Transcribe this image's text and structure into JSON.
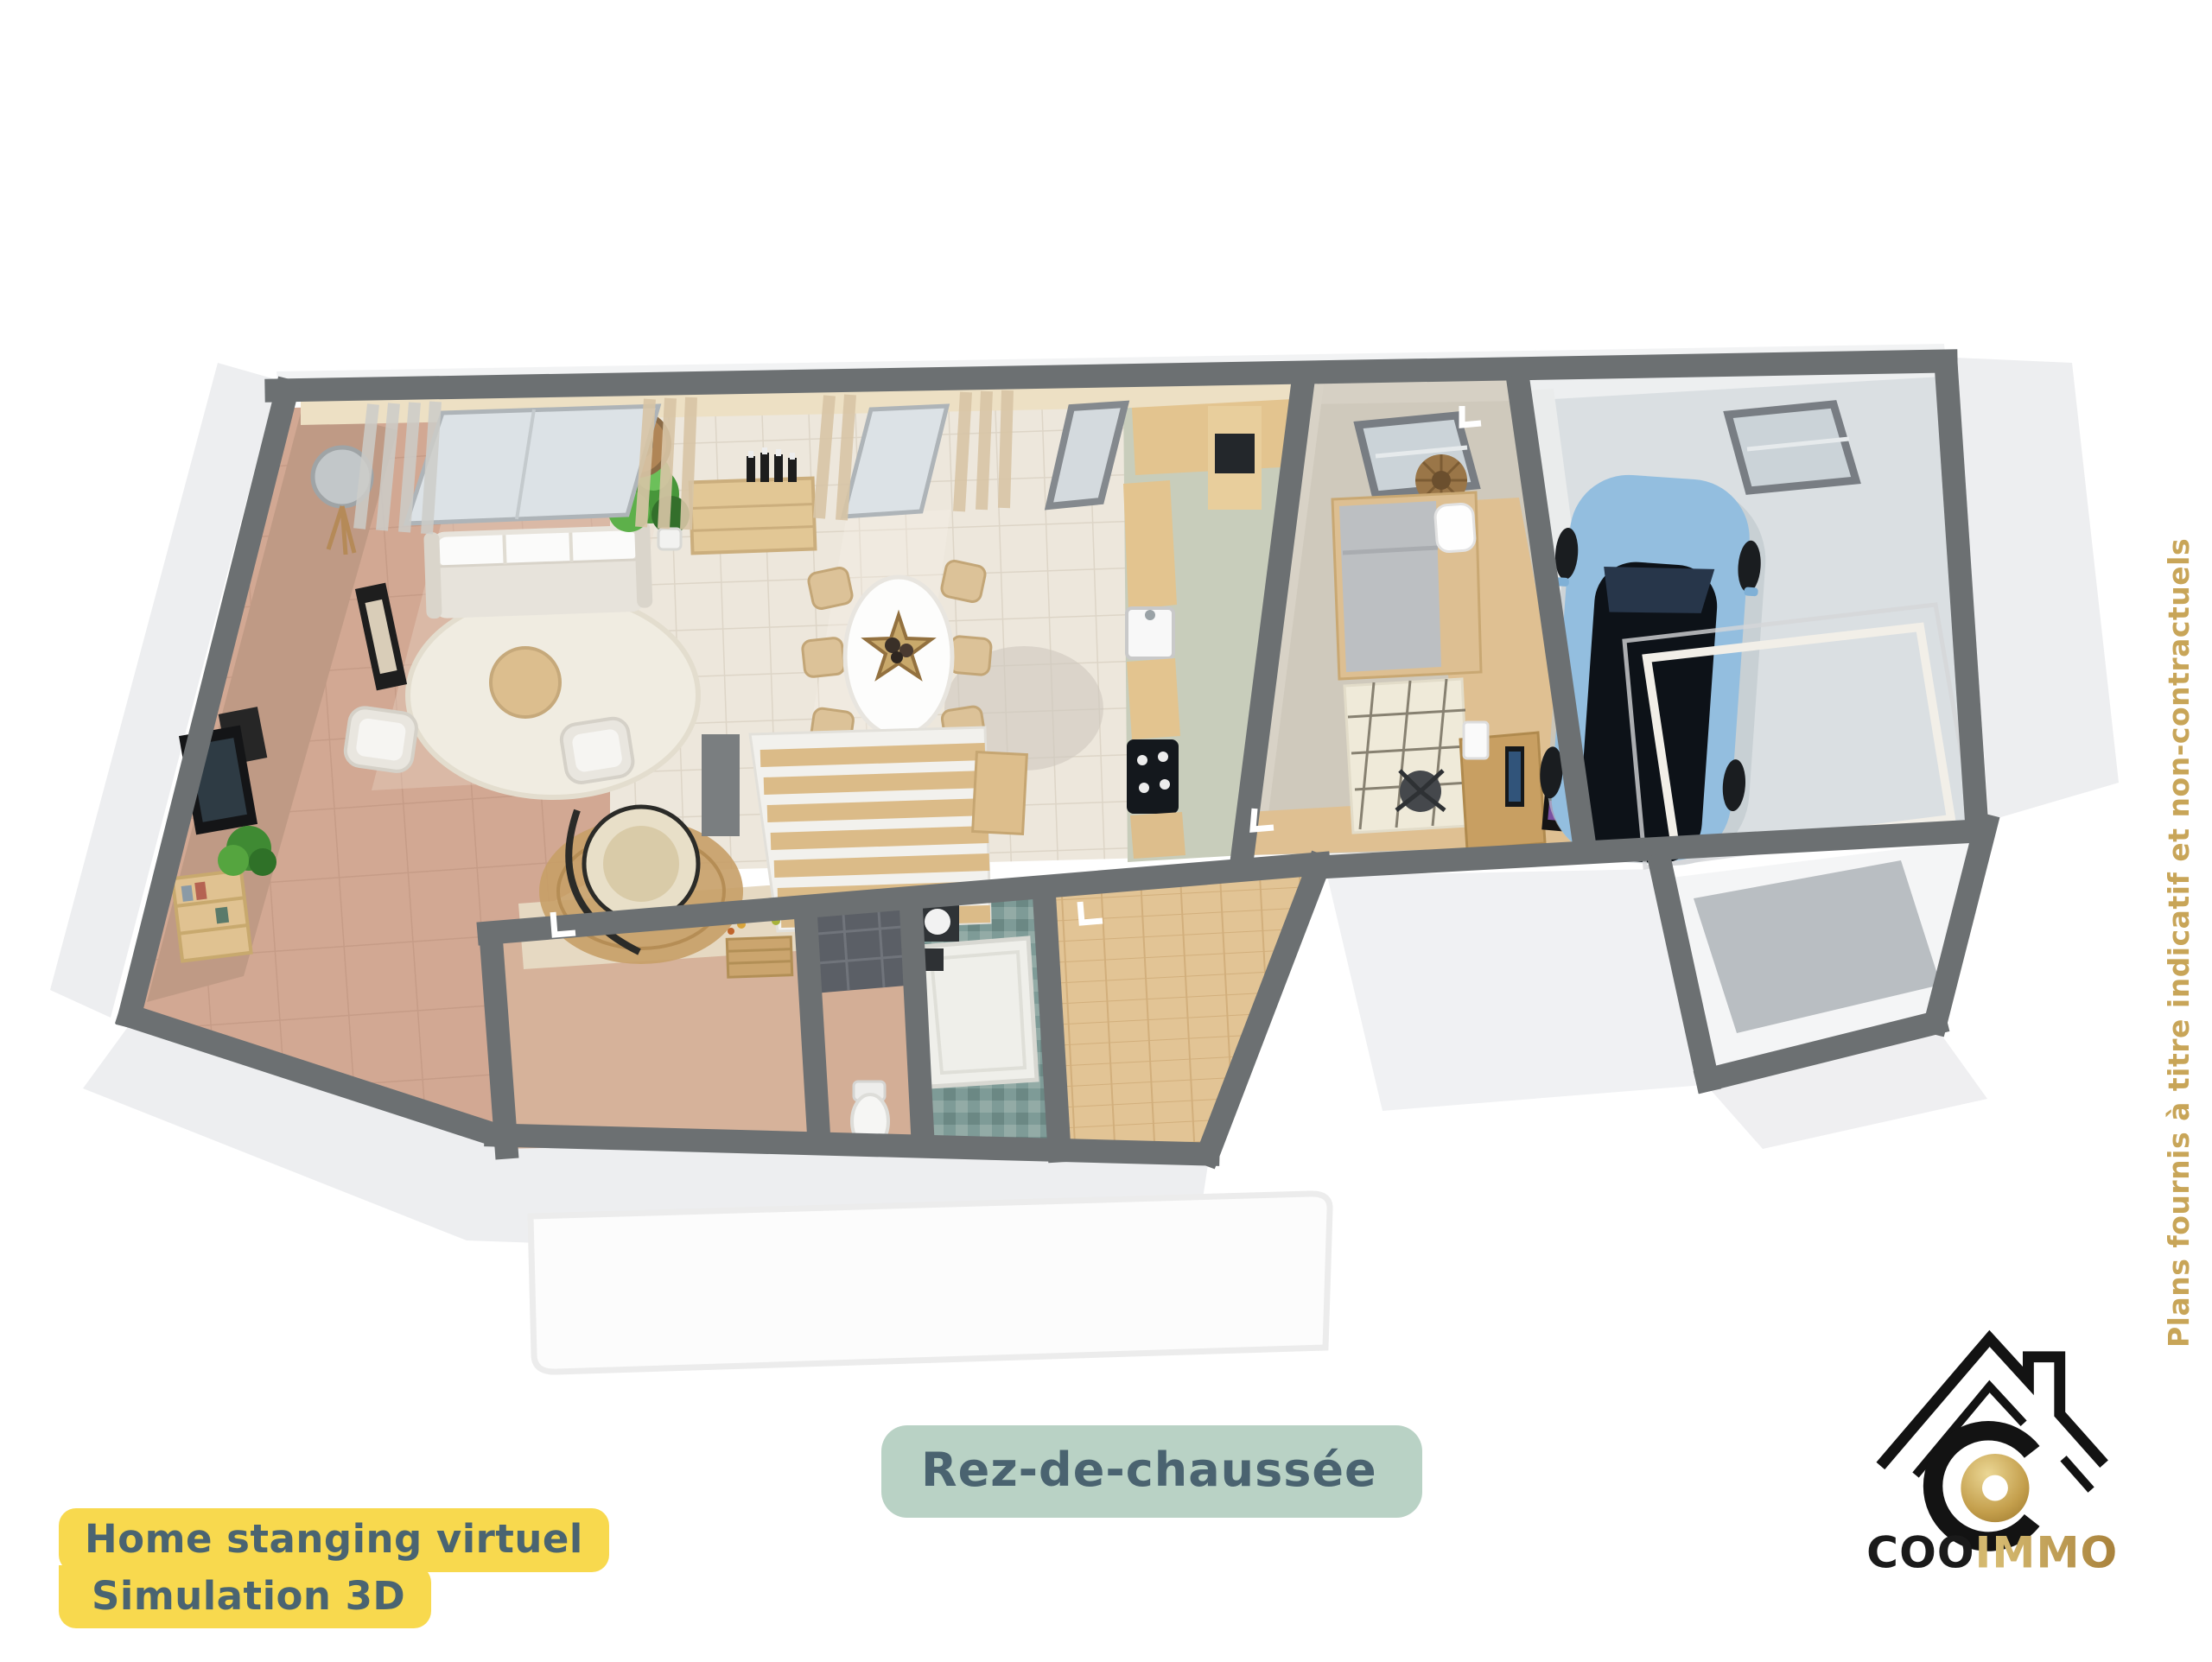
{
  "title_badge": {
    "line1": "Home stanging virtuel",
    "line2": "Simulation 3D"
  },
  "floor_label": "Rez-de-chaussée",
  "side_note": "Plans fournis à titre indicatif et non-contractuels",
  "logo": {
    "brand_black": "COO",
    "brand_gold": "IMMO"
  },
  "colors": {
    "badge_bg": "#F8D94E",
    "badge_text": "#4A6471",
    "pill_bg": "#B9D2C5",
    "pill_text": "#4A6370",
    "note_gold": "#C8A558",
    "wall_gray": "#6C7072",
    "living_floor": "#D2A893",
    "dining_tile": "#EDE7DC",
    "kitchen_floor": "#C8CDBB",
    "bedroom_floor": "#CFC9BC",
    "garage_floor": "#DADFE2",
    "bath_teal": "#7E9B97",
    "hall_wood": "#E2C495",
    "car_blue": "#93BEDF",
    "logo_black": "#1A1A1A",
    "logo_gold": "#C09A4A"
  },
  "floor_plan": {
    "view": "3d-perspective-top-down",
    "level": "ground-floor",
    "rooms": [
      {
        "name": "living-room",
        "features": [
          "sofa",
          "armchairs",
          "round-rug",
          "coffee-table",
          "floor-lamp",
          "tv",
          "bookcase",
          "plants",
          "curtains",
          "window",
          "hanging-egg-chair"
        ]
      },
      {
        "name": "dining-room",
        "features": [
          "oval-table",
          "six-chairs",
          "star-tray",
          "sideboard",
          "wine-bottles",
          "curtains",
          "windows",
          "staircase"
        ]
      },
      {
        "name": "kitchen",
        "features": [
          "wood-counters",
          "sink",
          "cooktop",
          "oven-column"
        ]
      },
      {
        "name": "bedroom-office",
        "features": [
          "bed",
          "diamond-rug",
          "skylight",
          "rattan-decor",
          "desk",
          "monitor",
          "office-chair"
        ]
      },
      {
        "name": "garage",
        "features": [
          "blue-car",
          "skylight",
          "garage-door-frame"
        ]
      },
      {
        "name": "entry-hall",
        "features": [
          "bench",
          "wall-flowers"
        ]
      },
      {
        "name": "wc",
        "features": [
          "toilet",
          "dark-tiled-wall"
        ]
      },
      {
        "name": "bathroom",
        "features": [
          "shower",
          "washbasin",
          "teal-checker-floor"
        ]
      },
      {
        "name": "rear-hallway",
        "features": [
          "wood-floor"
        ]
      },
      {
        "name": "porch",
        "features": []
      },
      {
        "name": "terrace",
        "features": []
      }
    ]
  }
}
